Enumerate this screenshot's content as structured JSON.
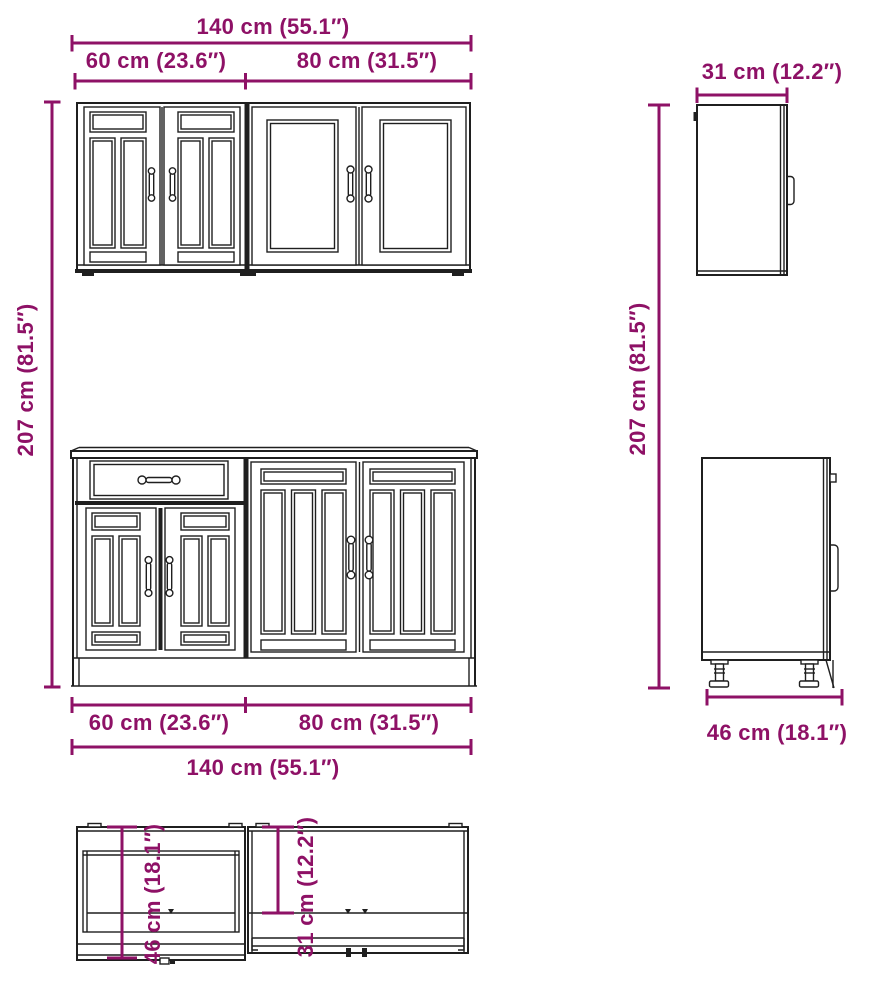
{
  "colors": {
    "dimension": "#8E1166",
    "line_art": "#1f1f1f",
    "background": "#ffffff"
  },
  "front_view": {
    "top_dimensions": {
      "total_width": "140 cm (55.1″)",
      "left_width": "60 cm (23.6″)",
      "right_width": "80 cm (31.5″)"
    },
    "left_height": "207 cm (81.5″)",
    "bottom_dimensions": {
      "left_width": "60 cm (23.6″)",
      "right_width": "80 cm (31.5″)",
      "total_width": "140 cm (55.1″)"
    }
  },
  "side_view": {
    "wall_cabinet_depth": "31 cm (12.2″)",
    "height": "207 cm (81.5″)",
    "base_cabinet_depth": "46 cm (18.1″)"
  },
  "top_view": {
    "base_cabinet_depth": "46 cm (18.1″)",
    "wall_cabinet_depth": "31 cm (12.2″)"
  }
}
